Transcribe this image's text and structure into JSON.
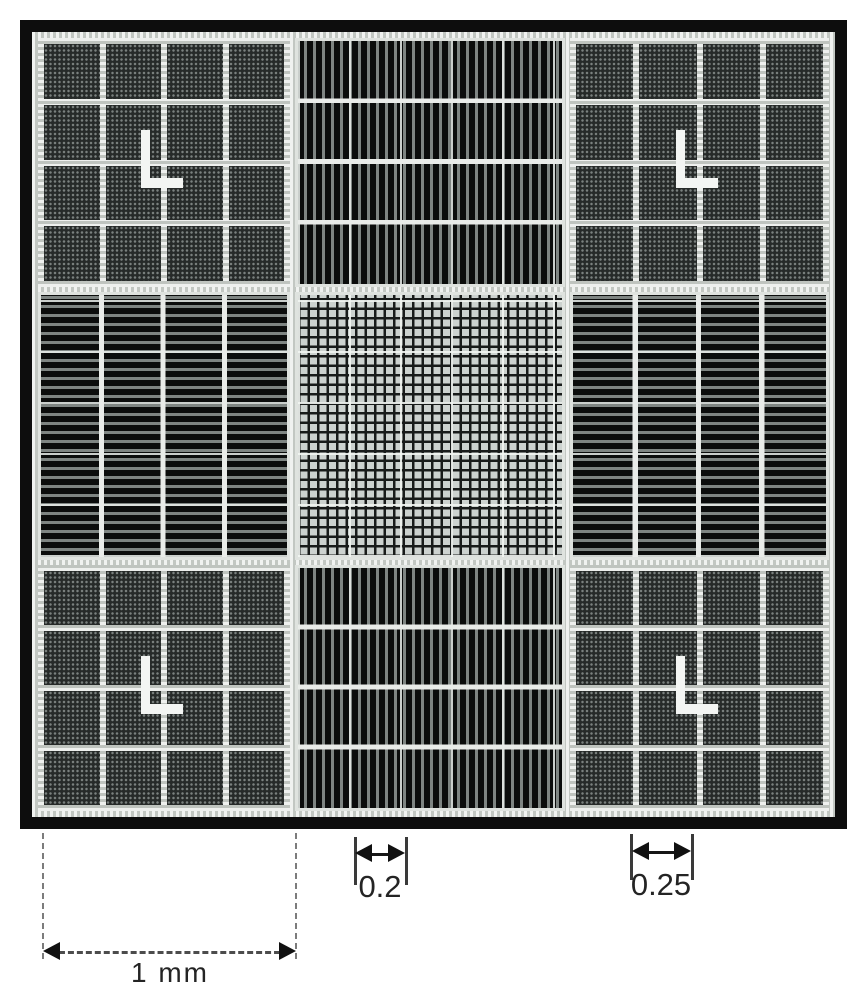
{
  "figure": {
    "name": "hemocytometer counting chamber grid",
    "colors": {
      "frame": "#0d0d0d",
      "background": "#ffffff",
      "grid_lines": "#e9ece9",
      "corner_mark": "#f3f5f3"
    },
    "cells": [
      {
        "position": "top-left",
        "pattern": "stippled-block-grid-4x4",
        "corner_mark": "L"
      },
      {
        "position": "top-center",
        "pattern": "fine-vertical-lines"
      },
      {
        "position": "top-right",
        "pattern": "stippled-block-grid-4x4",
        "corner_mark": "L"
      },
      {
        "position": "middle-left",
        "pattern": "fine-horizontal-lines"
      },
      {
        "position": "center",
        "pattern": "fine-crosshatch-mesh"
      },
      {
        "position": "middle-right",
        "pattern": "fine-horizontal-lines"
      },
      {
        "position": "bottom-left",
        "pattern": "stippled-block-grid-4x4",
        "corner_mark": "L"
      },
      {
        "position": "bottom-center",
        "pattern": "fine-vertical-lines"
      },
      {
        "position": "bottom-right",
        "pattern": "stippled-block-grid-4x4",
        "corner_mark": "L"
      }
    ],
    "annotations": {
      "width_label": "1 mm",
      "sub02_label": "0.2",
      "sub025_label": "0.25"
    }
  }
}
